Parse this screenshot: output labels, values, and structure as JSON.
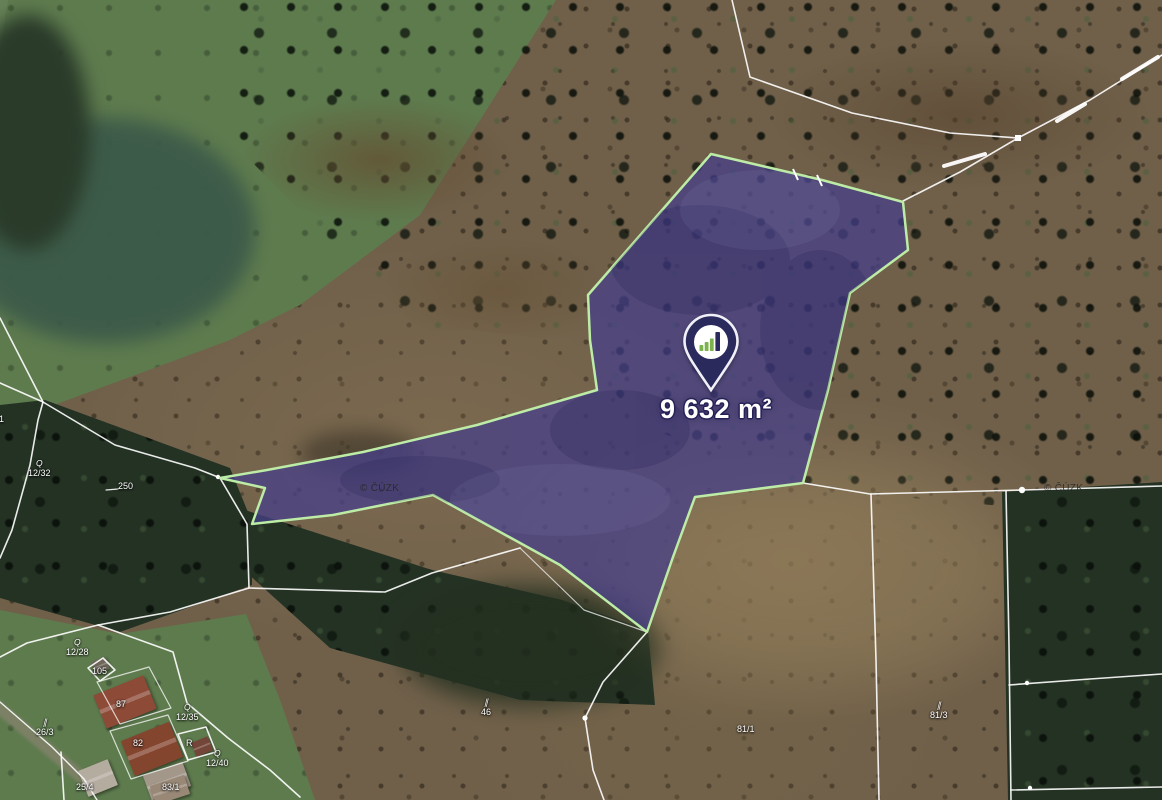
{
  "map": {
    "marker": {
      "area_label": "9 632 m²",
      "logo": "growth-bars-logo"
    },
    "watermarks": [
      {
        "text": "© ČÚZK",
        "x": 360,
        "y": 483
      },
      {
        "text": "© ČÚZK",
        "x": 1044,
        "y": 483
      }
    ],
    "parcel_labels": [
      {
        "text": "31",
        "x": -6,
        "y": 414,
        "symbol": ""
      },
      {
        "text": "12/32",
        "x": 28,
        "y": 458,
        "symbol": "Q"
      },
      {
        "text": "250",
        "x": 118,
        "y": 481,
        "symbol": ""
      },
      {
        "text": "12/28",
        "x": 66,
        "y": 637,
        "symbol": "Q"
      },
      {
        "text": "105",
        "x": 92,
        "y": 666,
        "symbol": ""
      },
      {
        "text": "87",
        "x": 116,
        "y": 699,
        "symbol": ""
      },
      {
        "text": "26/3",
        "x": 36,
        "y": 717,
        "symbol": "∥"
      },
      {
        "text": "12/35",
        "x": 176,
        "y": 702,
        "symbol": "Q"
      },
      {
        "text": "82",
        "x": 133,
        "y": 738,
        "symbol": ""
      },
      {
        "text": "R",
        "x": 186,
        "y": 738,
        "symbol": ""
      },
      {
        "text": "12/40",
        "x": 206,
        "y": 748,
        "symbol": "Q"
      },
      {
        "text": "25/4",
        "x": 76,
        "y": 782,
        "symbol": ""
      },
      {
        "text": "83/1",
        "x": 162,
        "y": 782,
        "symbol": ""
      },
      {
        "text": "46",
        "x": 481,
        "y": 697,
        "symbol": "∥"
      },
      {
        "text": "81/1",
        "x": 737,
        "y": 724,
        "symbol": ""
      },
      {
        "text": "81/3",
        "x": 930,
        "y": 700,
        "symbol": "∥"
      }
    ],
    "colors": {
      "parcel_fill": "#46408a",
      "parcel_outline": "#bdeca6",
      "pin_navy": "#2b2a5c",
      "logo_green": "#7cb34d",
      "boundary_white": "#ffffff"
    }
  }
}
